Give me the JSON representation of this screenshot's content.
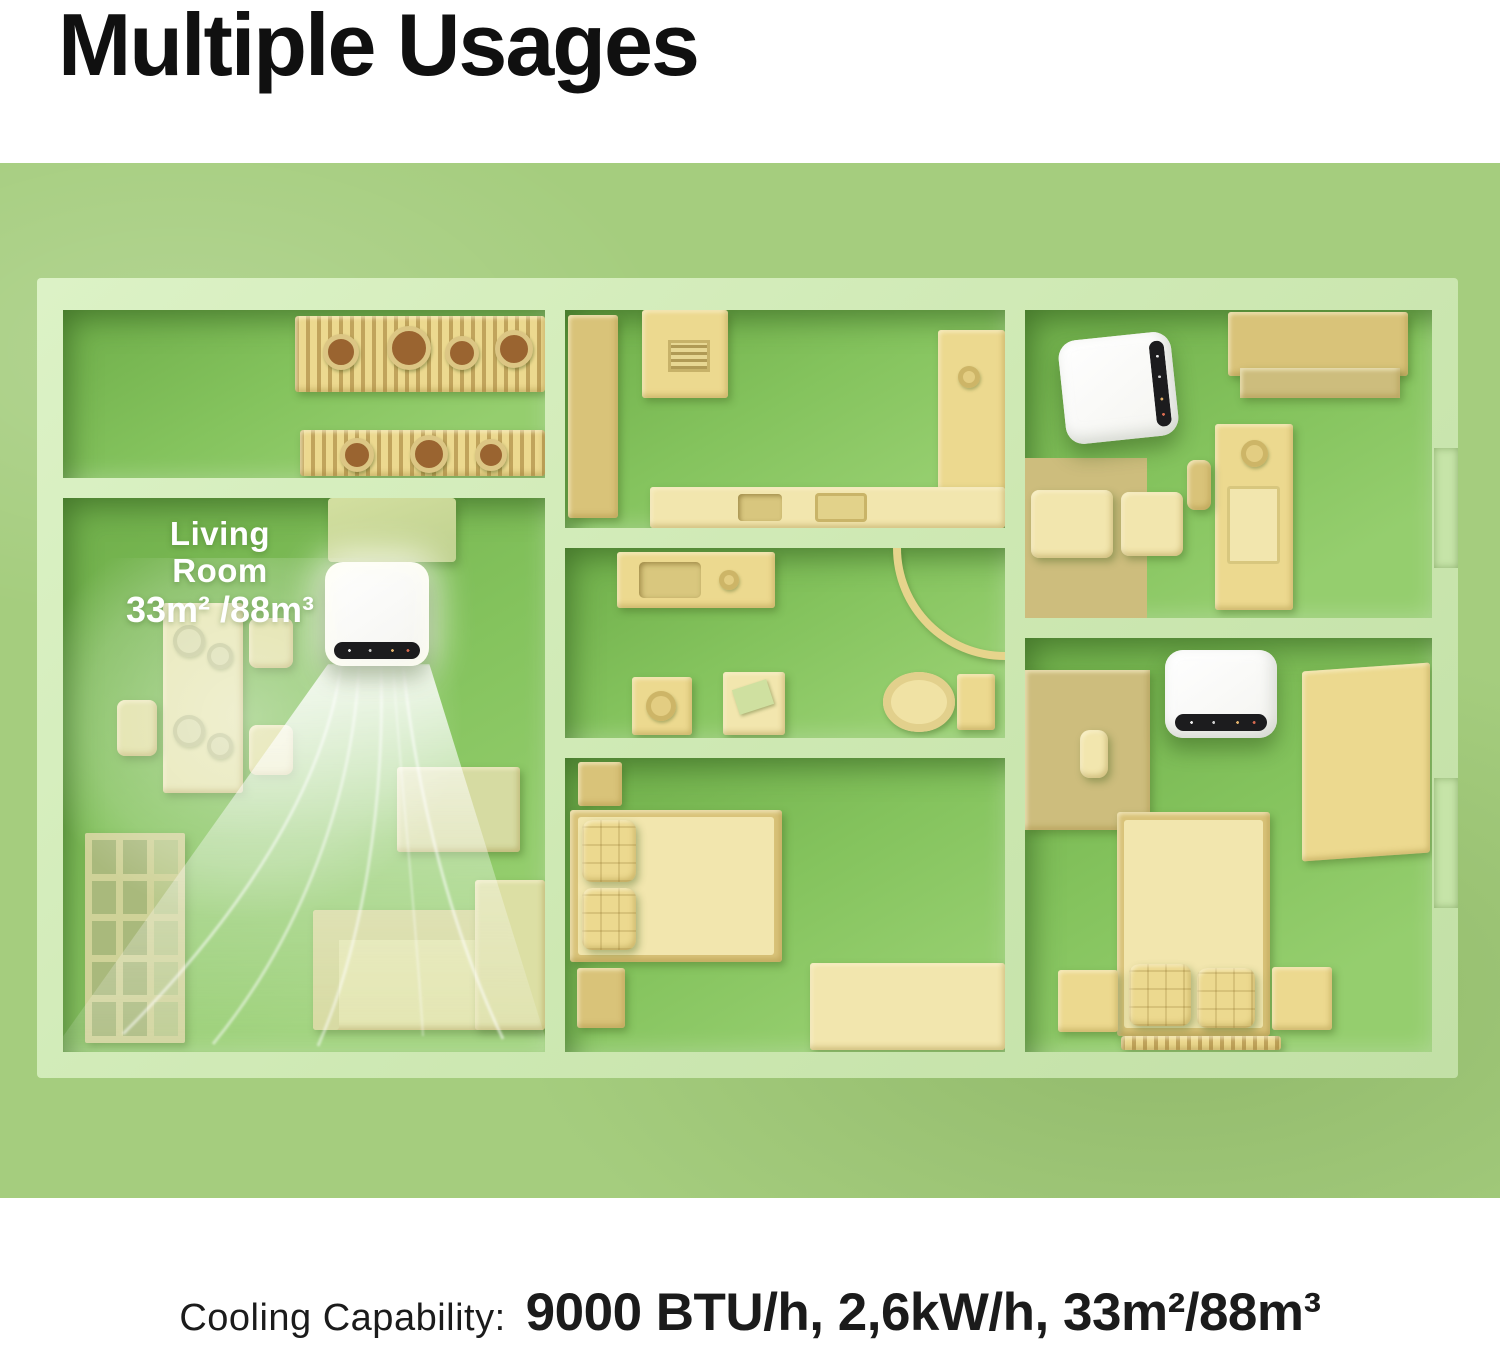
{
  "title": "Multiple Usages",
  "floor_plan": {
    "living_room_label": {
      "name": "Living Room",
      "area": "33m² /88m³"
    },
    "ac_unit_count": 3
  },
  "caption": {
    "label": "Cooling Capability:",
    "value": "9000 BTU/h, 2,6kW/h, 33m²/88m³"
  },
  "colors": {
    "background_green": "#a5cd7e",
    "wall_light_green": "#d3ecba",
    "floor_green": "#86c35f",
    "furniture_yellow": "#ecd98f",
    "ac_body_white": "#ffffff",
    "ac_panel_black": "#1c1c1e",
    "airflow_white": "#ffffff",
    "title_text": "#101010",
    "label_text": "#ffffff",
    "caption_text": "#1b1b1b"
  }
}
